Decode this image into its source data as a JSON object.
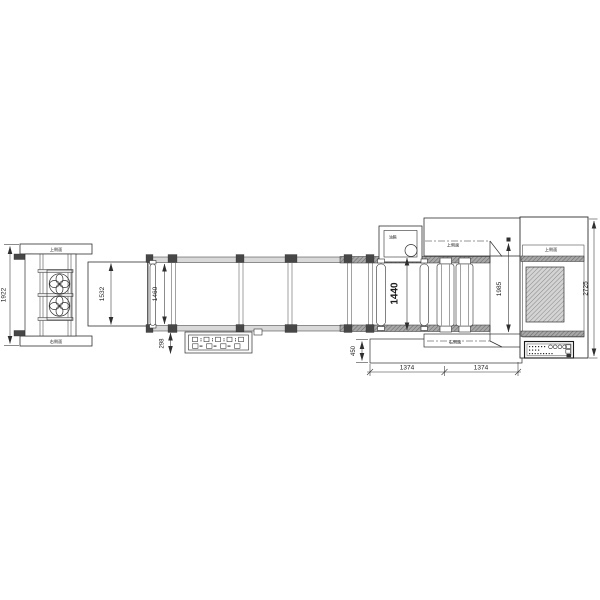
{
  "dimensions": {
    "left_overall": "1922",
    "infeed": "1532",
    "conveyor": "1460",
    "panel": "298",
    "belt": "1440",
    "base": "450",
    "span1": "1374",
    "span2": "1374",
    "outfeed": "1985",
    "right_overall": "2725"
  },
  "labels": {
    "left_top": "上侧面",
    "left_bottom": "右侧面",
    "mid_top": "上侧面",
    "mid_bottom": "右侧面",
    "right_top": "上侧面",
    "oil_box": "油箱"
  },
  "colors": {
    "line": "#2f2f2f",
    "rail_light": "#d9d9d9",
    "rail_dark": "#9a9a9a",
    "pad": "#474747",
    "background": "#ffffff"
  }
}
